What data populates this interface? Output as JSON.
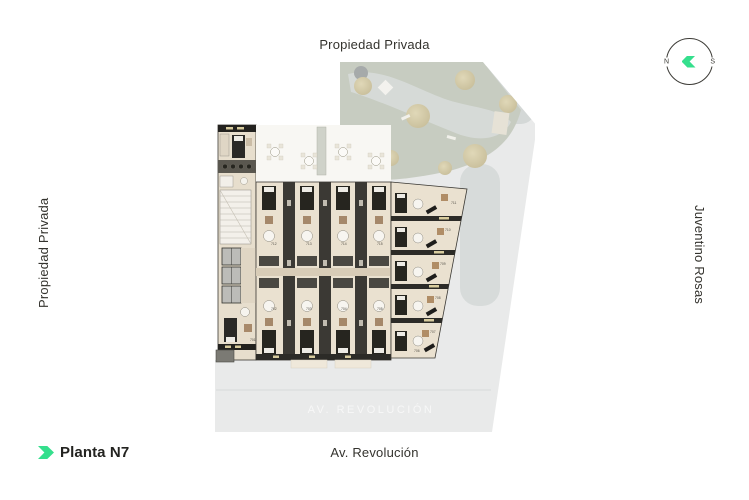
{
  "labels": {
    "top": "Propiedad Privada",
    "left": "Propiedad Privada",
    "right": "Juventino Rosas",
    "bottom": "Av. Revolución"
  },
  "legend": {
    "title": "Planta N7"
  },
  "compass": {
    "west": "N",
    "east": "S"
  },
  "plan": {
    "watermark": "AV. REVOLUCIÓN",
    "units": [
      {
        "label": "701",
        "x": 37,
        "y": 281
      },
      {
        "label": "702",
        "x": 58,
        "y": 250
      },
      {
        "label": "703",
        "x": 93,
        "y": 250
      },
      {
        "label": "704",
        "x": 128,
        "y": 250
      },
      {
        "label": "705",
        "x": 164,
        "y": 250
      },
      {
        "label": "706",
        "x": 201,
        "y": 292
      },
      {
        "label": "707",
        "x": 217,
        "y": 273
      },
      {
        "label": "708",
        "x": 222,
        "y": 239
      },
      {
        "label": "709",
        "x": 227,
        "y": 205
      },
      {
        "label": "710",
        "x": 232,
        "y": 171
      },
      {
        "label": "711",
        "x": 238,
        "y": 144
      },
      {
        "label": "712",
        "x": 58,
        "y": 185
      },
      {
        "label": "713",
        "x": 93,
        "y": 185
      },
      {
        "label": "714",
        "x": 128,
        "y": 185
      },
      {
        "label": "715",
        "x": 164,
        "y": 185
      },
      {
        "label": "716",
        "x": 37,
        "y": 111
      }
    ]
  },
  "colors": {
    "accent_green": "#35df8d",
    "text": "#34332e",
    "site_gray": "#e9eaea",
    "garden_green": "#c7ccc1",
    "floor_beige": "#eae1d0",
    "wall_dark": "#35332e"
  }
}
